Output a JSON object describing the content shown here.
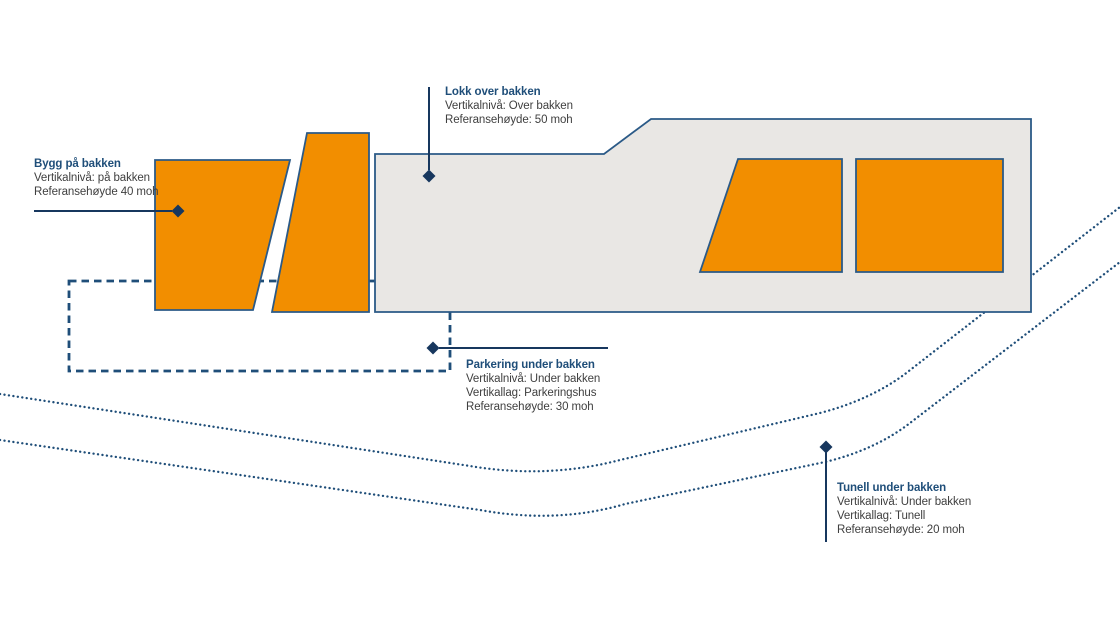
{
  "colors": {
    "orange": "#F28E00",
    "deck_gray": "#E9E7E4",
    "navy": "#1F4E79",
    "navy_dark": "#17375E",
    "outline_blue": "#2B5A87",
    "body_text": "#3F3F3F",
    "background": "#FFFFFF"
  },
  "diagram": {
    "callouts": {
      "bygg": {
        "title": "Bygg på bakken",
        "lines": [
          "Vertikalnivå: på bakken",
          "Referansehøyde 40 moh"
        ]
      },
      "lokk": {
        "title": "Lokk over bakken",
        "lines": [
          "Vertikalnivå: Over bakken",
          "Referansehøyde: 50 moh"
        ]
      },
      "parkering": {
        "title": "Parkering under bakken",
        "lines": [
          "Vertikalnivå: Under bakken",
          "Vertikallag: Parkeringshus",
          "Referansehøyde: 30 moh"
        ]
      },
      "tunell": {
        "title": "Tunell under bakken",
        "lines": [
          "Vertikalnivå: Under bakken",
          "Vertikallag: Tunell",
          "Referansehøyde: 20 moh"
        ]
      }
    }
  }
}
